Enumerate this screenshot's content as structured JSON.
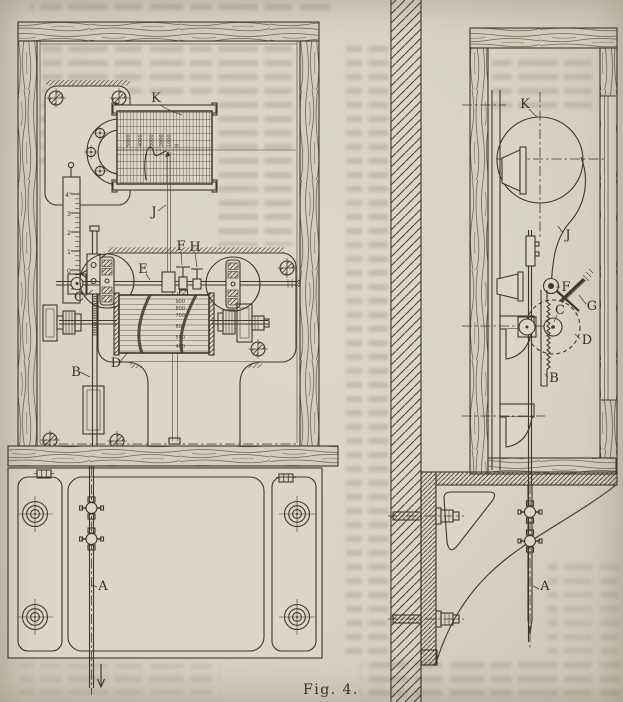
{
  "figure": {
    "caption": "Fig. 4."
  },
  "colors": {
    "paper": "#d8d3c4",
    "ink": "#3e382c",
    "ghost": "#aaa391",
    "wood": "#d3cdbc"
  },
  "left_view": {
    "description": "front elevation of recording gauge in wooden case on mounting plate",
    "labels": {
      "K": "K",
      "J": "J",
      "E": "E",
      "F": "F",
      "H": "H",
      "C": "C",
      "D": "D",
      "B": "B",
      "A": "A"
    },
    "drum_scale": [
      "5000",
      "4000",
      "3000",
      "2000",
      "1000",
      "0"
    ],
    "ruler_scale": [
      "4\"",
      "3",
      "2",
      "1",
      "0"
    ],
    "cylinder_scale": [
      "900",
      "800",
      "700",
      "600",
      "500",
      "400"
    ]
  },
  "right_view": {
    "description": "side section of case on wall bracket",
    "labels": {
      "K": "K",
      "J": "J",
      "F": "F",
      "G": "G",
      "C": "C",
      "D": "D",
      "B": "B",
      "A": "A"
    }
  }
}
